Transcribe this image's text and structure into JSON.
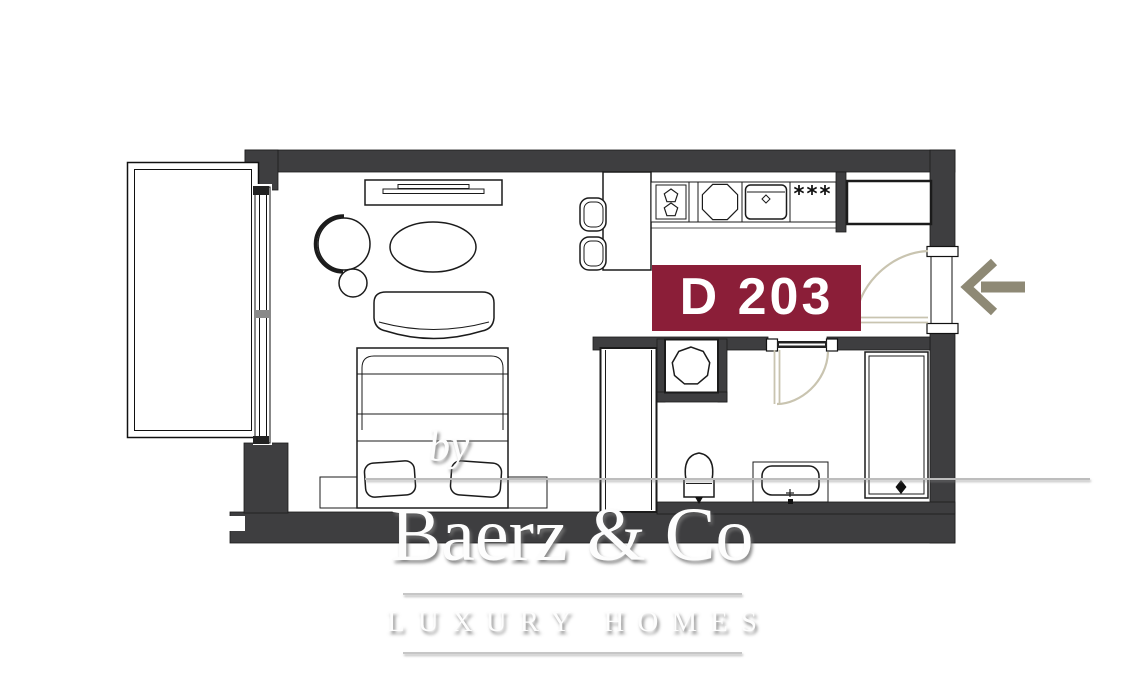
{
  "plan": {
    "unit_label": "D 203",
    "kitchen": {
      "freezer_symbol": "***"
    },
    "watermark": {
      "prefix": "by",
      "brand": "Baerz & Co",
      "tagline": "LUXURY HOMES"
    },
    "colors": {
      "wall": "#3E3E40",
      "line": "#1B1B1B",
      "unit_label_bg": "#8B1E38",
      "unit_label_text": "#FFFFFF",
      "door_swing": "#C9C4B0",
      "entry_arrow": "#8E8975",
      "watermark_text": "#FDFDFD",
      "watermark_rule": "#C6C6C6"
    },
    "icons": [
      "balcony",
      "sliding-window",
      "tv-console",
      "tv",
      "armchair",
      "ottoman",
      "coffee-table",
      "sofa",
      "double-bed",
      "pillows",
      "bench-platform",
      "bar-counter",
      "bar-stool",
      "hob-two-burners",
      "round-sink",
      "kitchen-sink-unit",
      "freezer-stars",
      "tall-cabinet",
      "wardrobe",
      "washing-machine",
      "toilet",
      "vanity-sink",
      "shower",
      "entry-door-swing",
      "bathroom-door-swing",
      "entry-arrow"
    ]
  }
}
